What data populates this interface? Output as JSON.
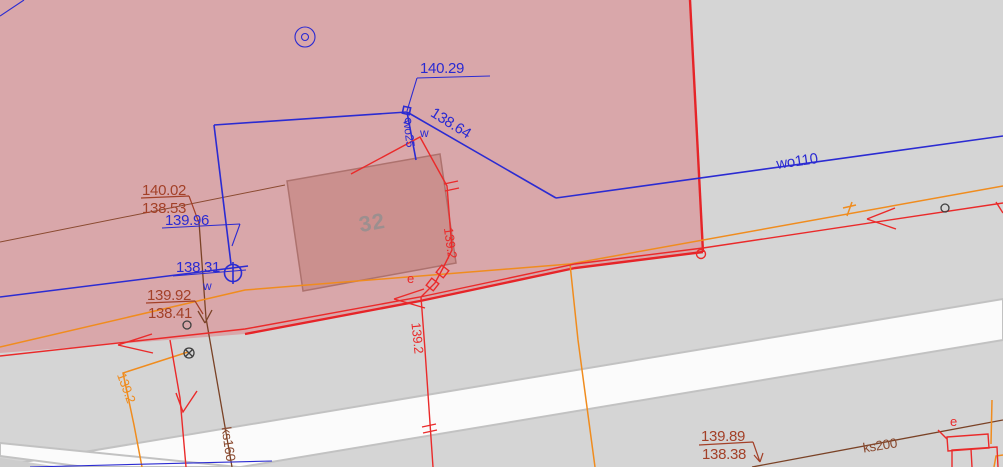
{
  "map": {
    "colors": {
      "background": "#d5d5d5",
      "road": "#fbfbfb",
      "parcel_fill": "rgba(227,64,74,0.30)",
      "parcel_border": "#e62428",
      "water_blue": "#2b2bd2",
      "power_orange": "#f08c1e",
      "cable_red": "#ea2a2a",
      "sewer_line_brown": "#7a4226",
      "sewer_label_brown": "#a34028",
      "building_fill": "#c0b4ac",
      "building_label": "#9c8f8f"
    },
    "building": {
      "number": "32"
    },
    "water": {
      "main_label": "wo110",
      "service_label": "wo25",
      "meter_label_node": "w",
      "meter_label_hydrant": "w",
      "elev_node": "140.29",
      "elev_diagonal": "138.64",
      "elev_riser": "139.96",
      "elev_hydrant": "138.31"
    },
    "sewer": {
      "ks160_label": "ks160",
      "ks200_label": "ks200",
      "manhole_left": {
        "top": "140.02",
        "bottom": "138.53"
      },
      "manhole_left2": {
        "top": "139.92",
        "bottom": "138.41"
      },
      "manhole_right": {
        "top": "139.89",
        "bottom": "138.38"
      }
    },
    "power": {
      "elev": "139.2"
    },
    "cable": {
      "e_mid": "e",
      "e_right": "e",
      "elev_a": "139.2",
      "elev_b": "139.2"
    }
  }
}
